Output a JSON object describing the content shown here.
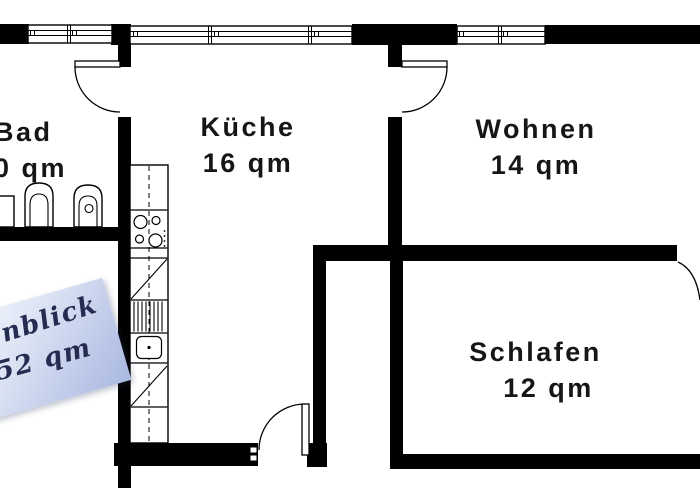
{
  "title": "Apartment floor plan",
  "rooms": {
    "bad": {
      "name": "Bad",
      "area": "0 qm"
    },
    "kueche": {
      "name": "Küche",
      "area": "16 qm"
    },
    "wohnen": {
      "name": "Wohnen",
      "area": "14 qm"
    },
    "schlafen": {
      "name": "Schlafen",
      "area": "12 qm"
    }
  },
  "note": {
    "line1": "nblick",
    "line2": "52 qm"
  },
  "colors": {
    "wall": "#000000",
    "background": "#ffffff",
    "note_light": "#f6f9fe",
    "note_dark": "#a9b8e1",
    "note_text": "#252c52"
  }
}
